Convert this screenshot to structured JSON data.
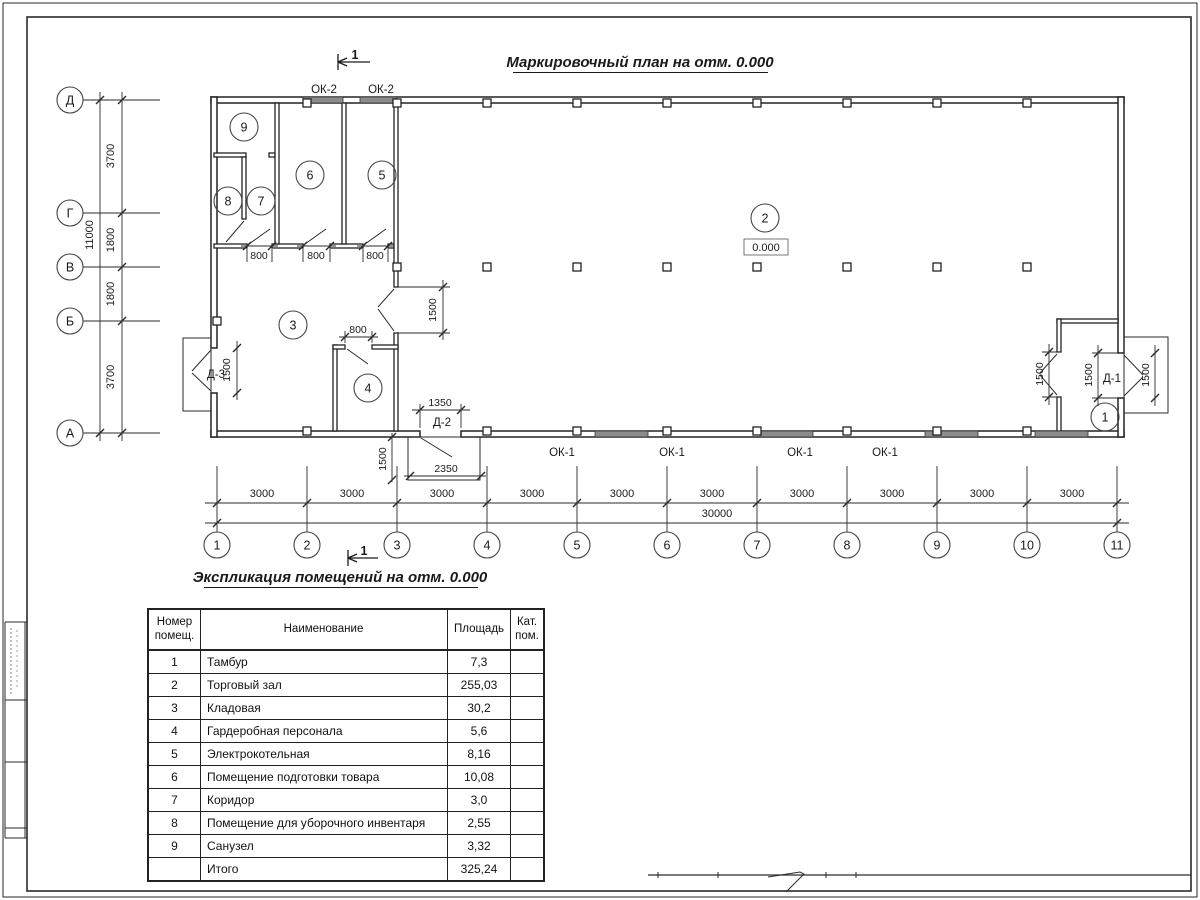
{
  "sheet": {
    "title": "Маркировочный план на отм. 0.000",
    "table_title": "Экспликация помещений на отм. 0.000",
    "section_mark": "1",
    "elevation": "0.000"
  },
  "axes": {
    "bottom": [
      "1",
      "2",
      "3",
      "4",
      "5",
      "6",
      "7",
      "8",
      "9",
      "10",
      "11"
    ],
    "left": [
      "Д",
      "Г",
      "В",
      "Б",
      "А"
    ]
  },
  "dims": {
    "d3000": "3000",
    "d30000": "30000",
    "d3700": "3700",
    "d1800": "1800",
    "d11000": "11000",
    "d1500": "1500",
    "d800": "800",
    "d1350": "1350",
    "d2350": "2350"
  },
  "marks": {
    "door1": "Д-1",
    "door2": "Д-2",
    "door3": "Д-3",
    "window1": "ОК-1",
    "window2": "ОК-2"
  },
  "table": {
    "headers": {
      "num_l1": "Номер",
      "num_l2": "помещ.",
      "name": "Наименование",
      "area": "Площадь",
      "cat_l1": "Кат.",
      "cat_l2": "пом."
    },
    "rows": [
      {
        "num": "1",
        "name": "Тамбур",
        "area": "7,3",
        "cat": ""
      },
      {
        "num": "2",
        "name": "Торговый зал",
        "area": "255,03",
        "cat": ""
      },
      {
        "num": "3",
        "name": "Кладовая",
        "area": "30,2",
        "cat": ""
      },
      {
        "num": "4",
        "name": "Гардеробная персонала",
        "area": "5,6",
        "cat": ""
      },
      {
        "num": "5",
        "name": "Электрокотельная",
        "area": "8,16",
        "cat": ""
      },
      {
        "num": "6",
        "name": "Помещение подготовки товара",
        "area": "10,08",
        "cat": ""
      },
      {
        "num": "7",
        "name": "Коридор",
        "area": "3,0",
        "cat": ""
      },
      {
        "num": "8",
        "name": "Помещение для уборочного инвентаря",
        "area": "2,55",
        "cat": ""
      },
      {
        "num": "9",
        "name": "Санузел",
        "area": "3,32",
        "cat": ""
      },
      {
        "num": "",
        "name": "Итого",
        "area": "325,24",
        "cat": ""
      }
    ]
  }
}
